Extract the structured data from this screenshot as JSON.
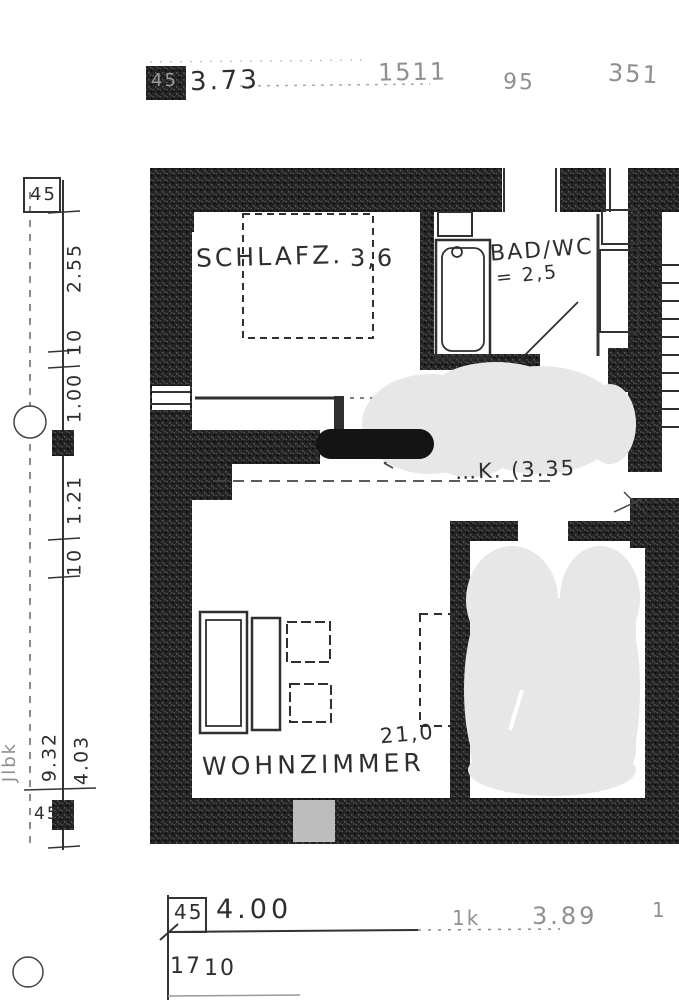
{
  "colors": {
    "paper": "#ffffff",
    "ink": "#2e2e2e",
    "wall": "#232323",
    "faint_ink": "#8f8f8f",
    "redaction_bar": "#141414",
    "redaction_blob": "#e7e7e7"
  },
  "top_strip": {
    "ref_box": "45",
    "dimension": "3.73",
    "faint_numbers": [
      "1511",
      "95",
      "351"
    ]
  },
  "left_dim_chain": {
    "top_box": "45",
    "segments": [
      "2.55",
      "10",
      "1.00",
      "1.21",
      "10"
    ],
    "totals": [
      "9.32",
      "4.03"
    ],
    "bottom_label": "45",
    "margin_scribble": "Jlbk"
  },
  "floor_plan": {
    "rooms": [
      {
        "name": "SCHLAFZ.",
        "area": "3,6"
      },
      {
        "name": "BAD/WC",
        "area": "= 2,5"
      },
      {
        "name": "WOHNZIMMER",
        "area": "21,0"
      }
    ],
    "corridor_note": "…K. (3.35",
    "symbols": [
      "bed",
      "bathtub",
      "sink",
      "sofa",
      "armchair",
      "side-tables",
      "stairs",
      "door-swing",
      "datum-circle",
      "redaction-bar",
      "redaction-blob"
    ]
  },
  "bottom_dim_chain": {
    "ref_box": "45",
    "dimension": "4.00",
    "sub_labels": [
      "17",
      "10"
    ],
    "faint_labels": [
      "1k",
      "3.89",
      "1"
    ]
  }
}
